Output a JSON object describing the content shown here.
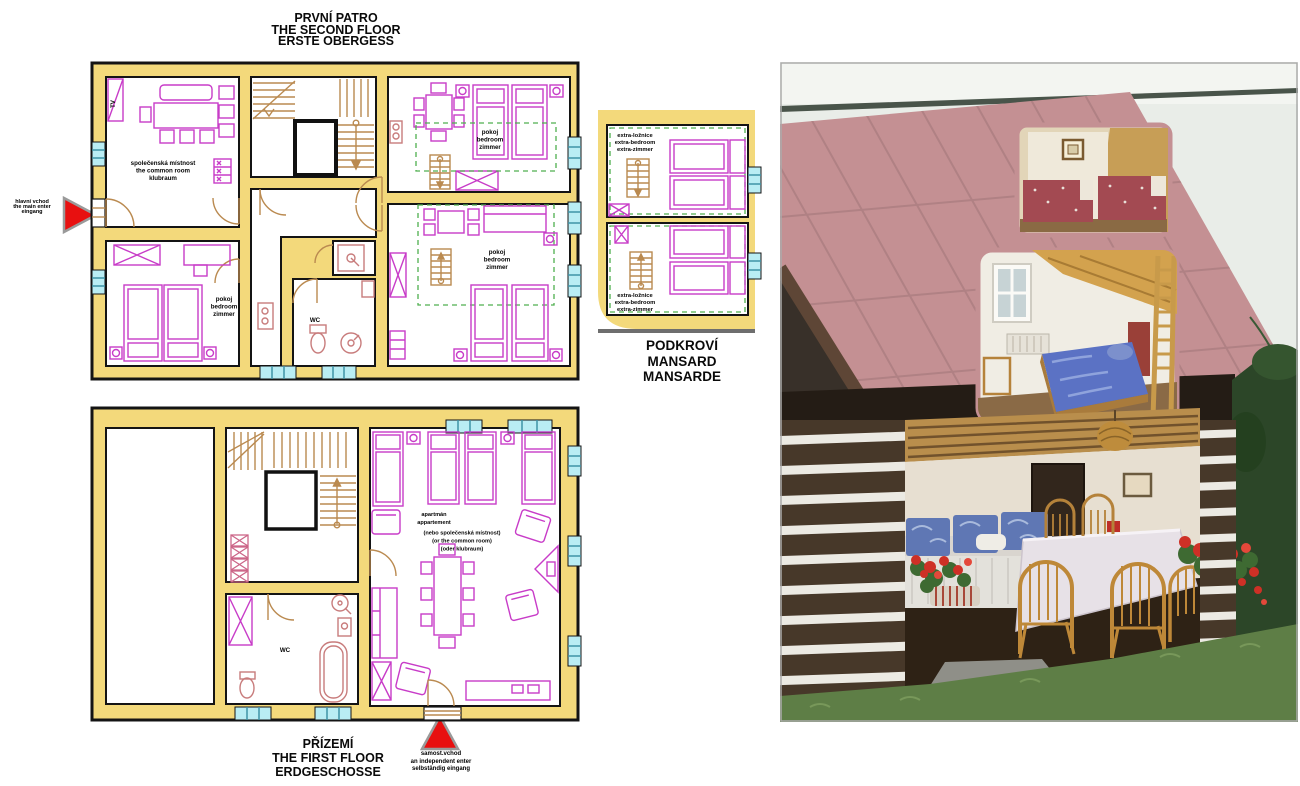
{
  "sheet": {
    "background": "#FFFFFF"
  },
  "colors": {
    "wall": "#F3D97B",
    "outline": "#141414",
    "furniture": "#C83CC8",
    "sanitary": "#C87C7C",
    "wood": "#BA8A50",
    "window": "#B9EDF4",
    "dashed_border": "#4FAF4F",
    "entrance_arrow": "#E81010",
    "roof": "#C49093",
    "log_wall": "#473829",
    "grass": "#5E7E46"
  },
  "first_floor": {
    "title": [
      "PRVNÍ PATRO",
      "THE SECOND FLOOR",
      "ERSTE OBERGESS"
    ],
    "entrance": [
      "hlavní vchod",
      "the main enter",
      "eingang"
    ],
    "rooms": {
      "common_room": [
        "společenská místnost",
        "the common room",
        "klubraum"
      ],
      "bedroom_top_right": [
        "pokoj",
        "bedroom",
        "zimmer"
      ],
      "bedroom_bottom_left": [
        "pokoj",
        "bedroom",
        "zimmer"
      ],
      "bedroom_bottom_right": [
        "pokoj",
        "bedroom",
        "zimmer"
      ],
      "wc": "WC",
      "tv": "TV"
    }
  },
  "mansard": {
    "title": [
      "PODKROVÍ",
      "MANSARD",
      "MANSARDE"
    ],
    "rooms": {
      "extra_bedroom_top": [
        "extra-ložnice",
        "extra-bedroom",
        "extra-zimmer"
      ],
      "extra_bedroom_bottom": [
        "extra-ložnice",
        "extra-bedroom",
        "extra-zimmer"
      ]
    }
  },
  "ground_floor": {
    "title": [
      "PŘÍZEMÍ",
      "THE FIRST FLOOR",
      "ERDGESCHOSSE"
    ],
    "entrance": [
      "samost.vchod",
      "an independent enter",
      "selbständig eingang"
    ],
    "rooms": {
      "apartment": [
        "apartmán",
        "appartement",
        "(nebo společenská místnost)",
        "(or the common room)",
        "(oder klubraum)"
      ],
      "wc": "WC"
    }
  }
}
